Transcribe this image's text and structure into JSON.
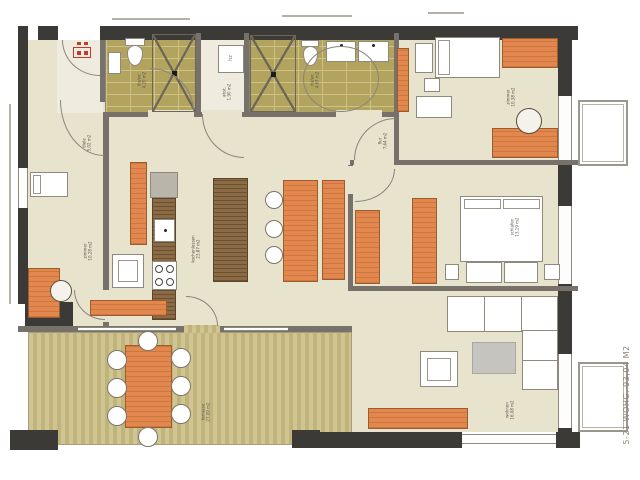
{
  "plan": {
    "unit_label": "5-21 WOHG.  93,04 M2",
    "heater_label": "hz",
    "rooms": [
      {
        "name": "diele",
        "area": "5,02 m2"
      },
      {
        "name": "du/wc",
        "area": "4,20 m2"
      },
      {
        "name": "abst.",
        "area": "1,90 m2"
      },
      {
        "name": "du/wc",
        "area": "4,67 m2"
      },
      {
        "name": "zimmer",
        "area": "10,38 m2"
      },
      {
        "name": "flur",
        "area": "7,64 m2"
      },
      {
        "name": "zimmer",
        "area": "10,28 m2"
      },
      {
        "name": "kochen/essen",
        "area": "23,87 m2"
      },
      {
        "name": "schlafen",
        "area": "13,19 m2"
      },
      {
        "name": "wohnen",
        "area": "16,08 m2"
      },
      {
        "name": "terrasse",
        "area": "27,09 m2"
      }
    ],
    "colors": {
      "wall_dark": "#3c3a36",
      "wall_mid": "#76716a",
      "floor": "#e7e3cc",
      "tile": "#b2a45f",
      "terrace_a": "#cfc492",
      "terrace_b": "#c0b47b",
      "furniture_orange": "#e2884f",
      "wood_dark": "#8a6b45",
      "accent_red": "#c03b2d"
    }
  }
}
